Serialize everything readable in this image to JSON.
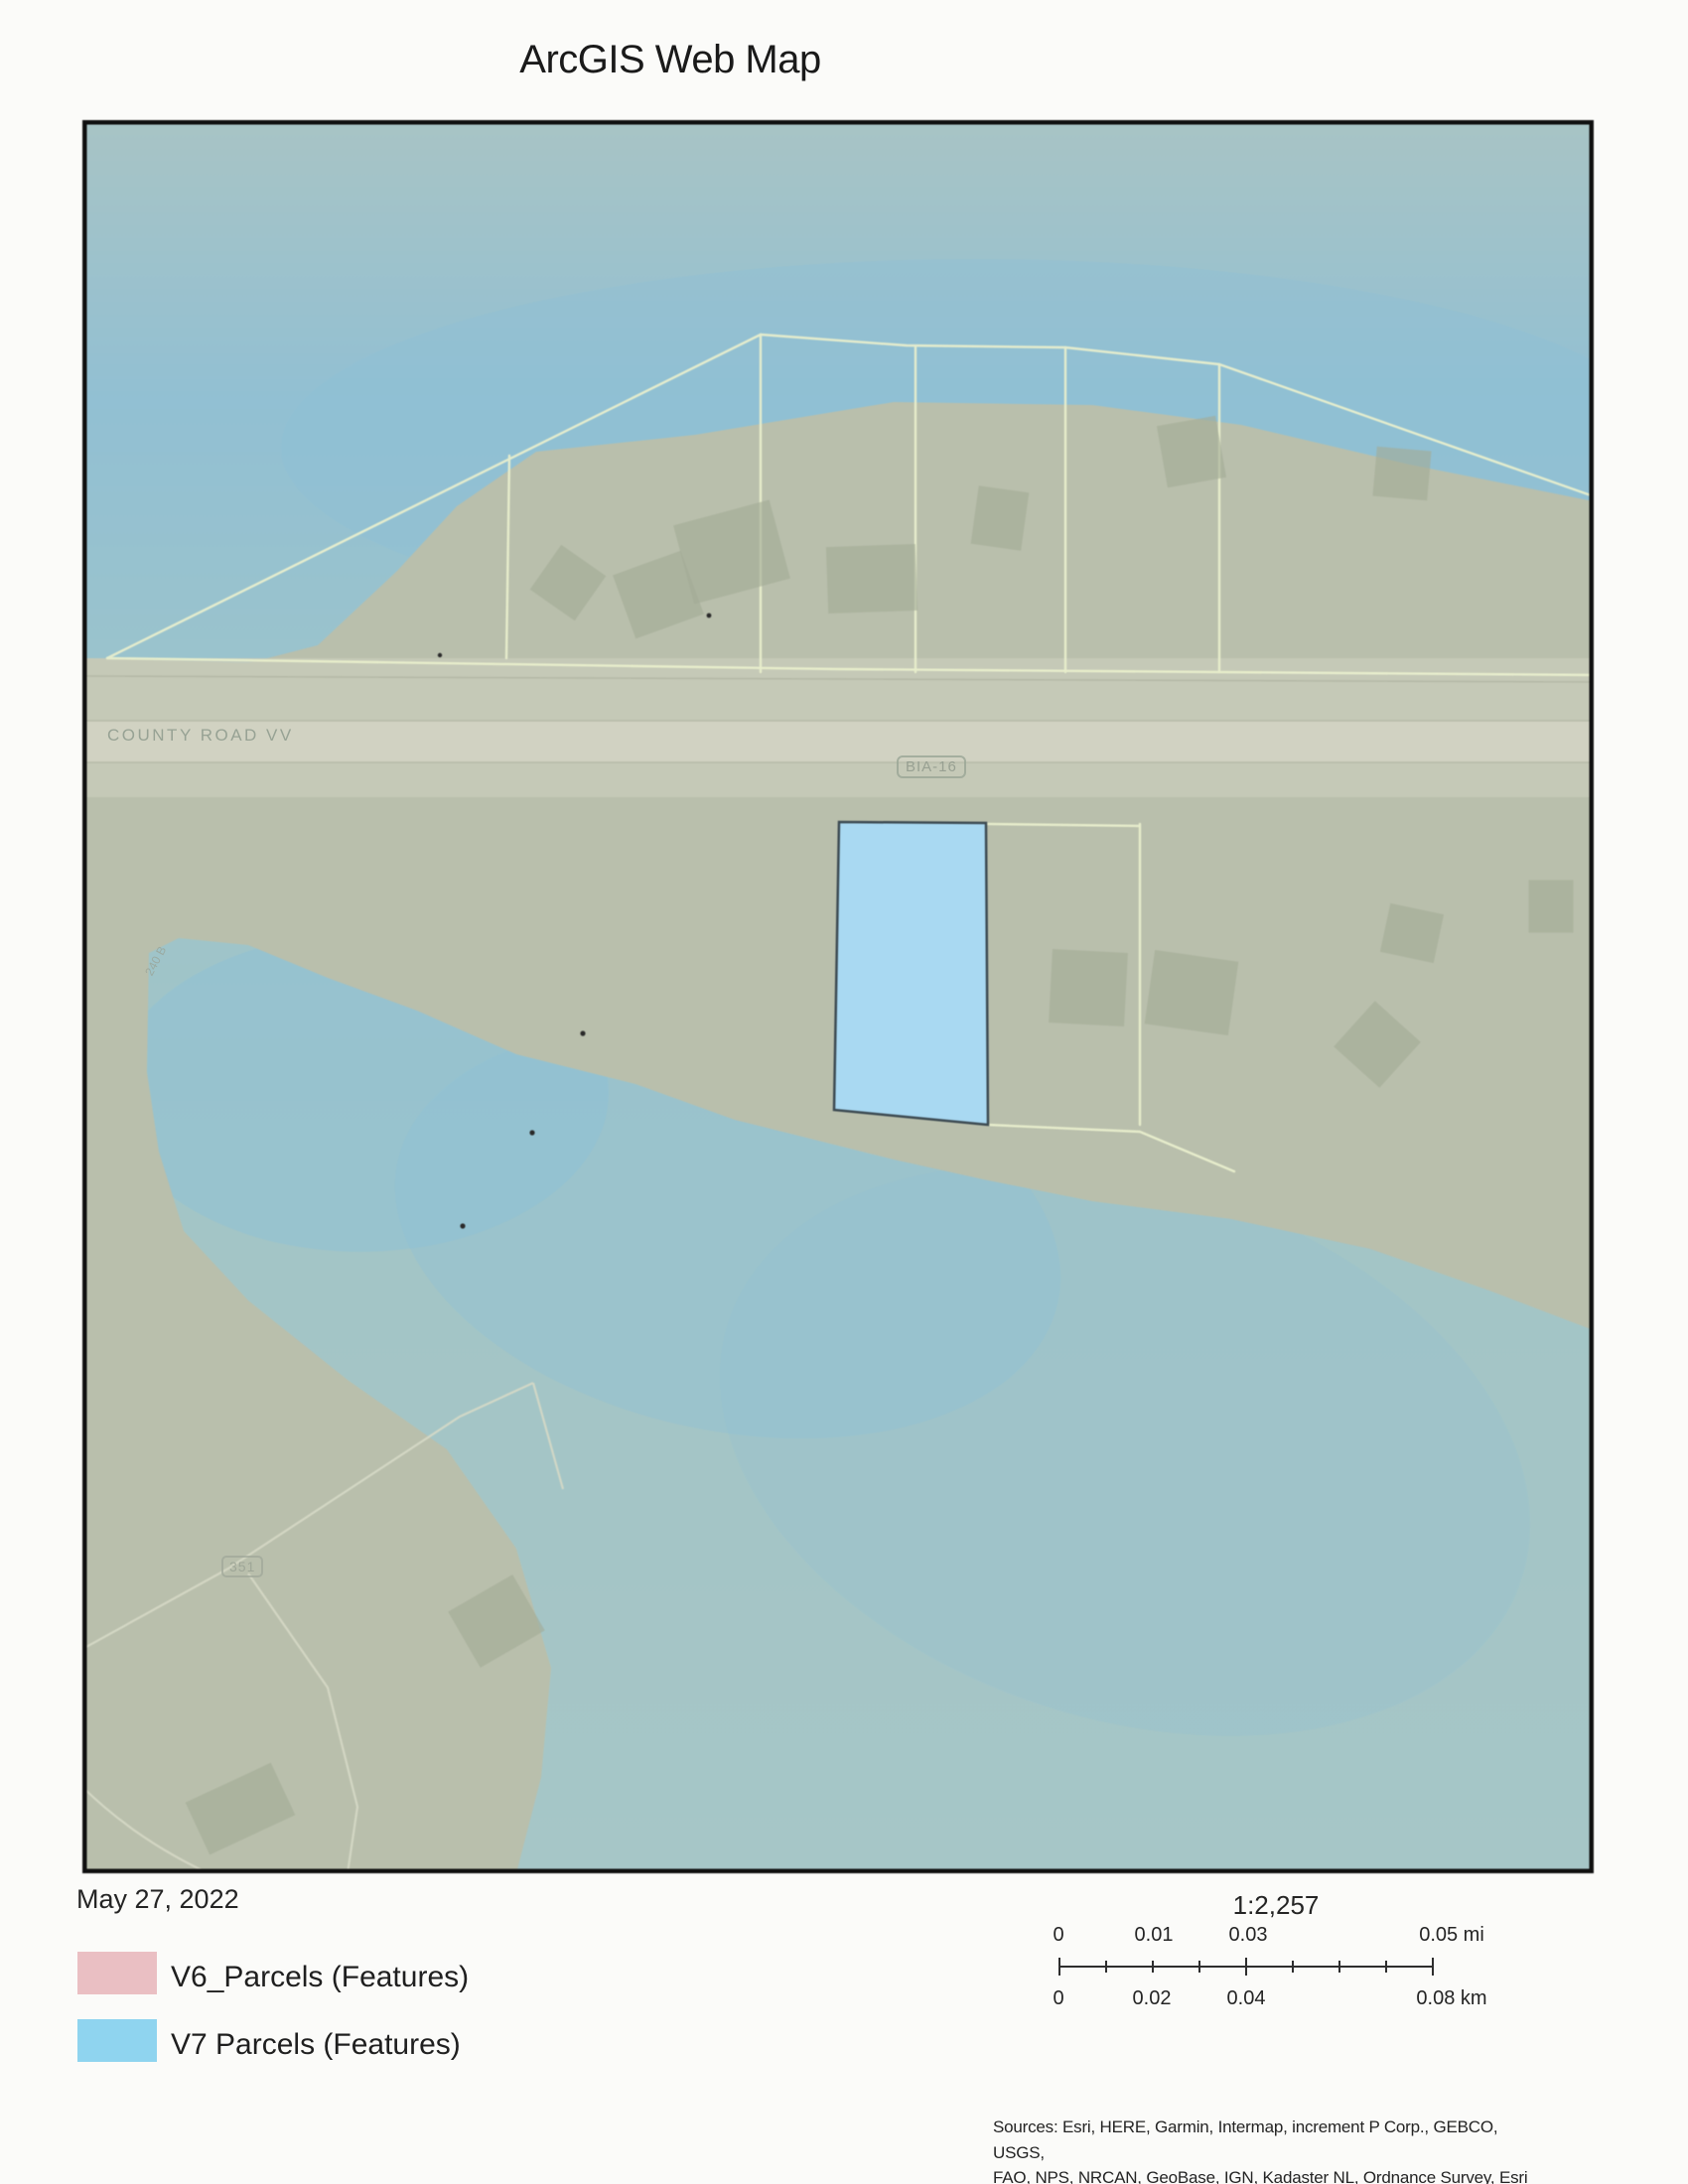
{
  "page": {
    "title": "ArcGIS Web Map",
    "date": "May 27, 2022"
  },
  "legend": {
    "items": [
      {
        "label": "V6_Parcels (Features)",
        "color": "#eabfc3"
      },
      {
        "label": "V7 Parcels (Features)",
        "color": "#8fd4ef"
      }
    ]
  },
  "scale": {
    "ratio": "1:2,257",
    "mi_labels": [
      "0",
      "0.01",
      "0.03",
      "0.05 mi"
    ],
    "km_labels": [
      "0",
      "0.02",
      "0.04",
      "0.08 km"
    ]
  },
  "map": {
    "road_labels": {
      "county_road": "COUNTY ROAD VV",
      "bia": "BIA-16",
      "local_road": "351",
      "small_road": "240 B"
    },
    "colors": {
      "water_top": "#a8c4c5",
      "water_blue": "#92c0d3",
      "water_lower": "#a3c5c6",
      "land": "#b9bfac",
      "road_corridor": "#c7cab8",
      "road_surface": "#d1d3c3",
      "parcel_line": "#e9efcd",
      "highlight_parcel_fill": "#a9d9f2",
      "highlight_parcel_stroke": "#3c4a52"
    }
  },
  "sources": {
    "line1": "Sources: Esri, HERE, Garmin, Intermap, increment P Corp., GEBCO, USGS,",
    "line2": "FAO, NPS, NRCAN, GeoBase, IGN, Kadaster NL, Ordnance Survey, Esri"
  }
}
